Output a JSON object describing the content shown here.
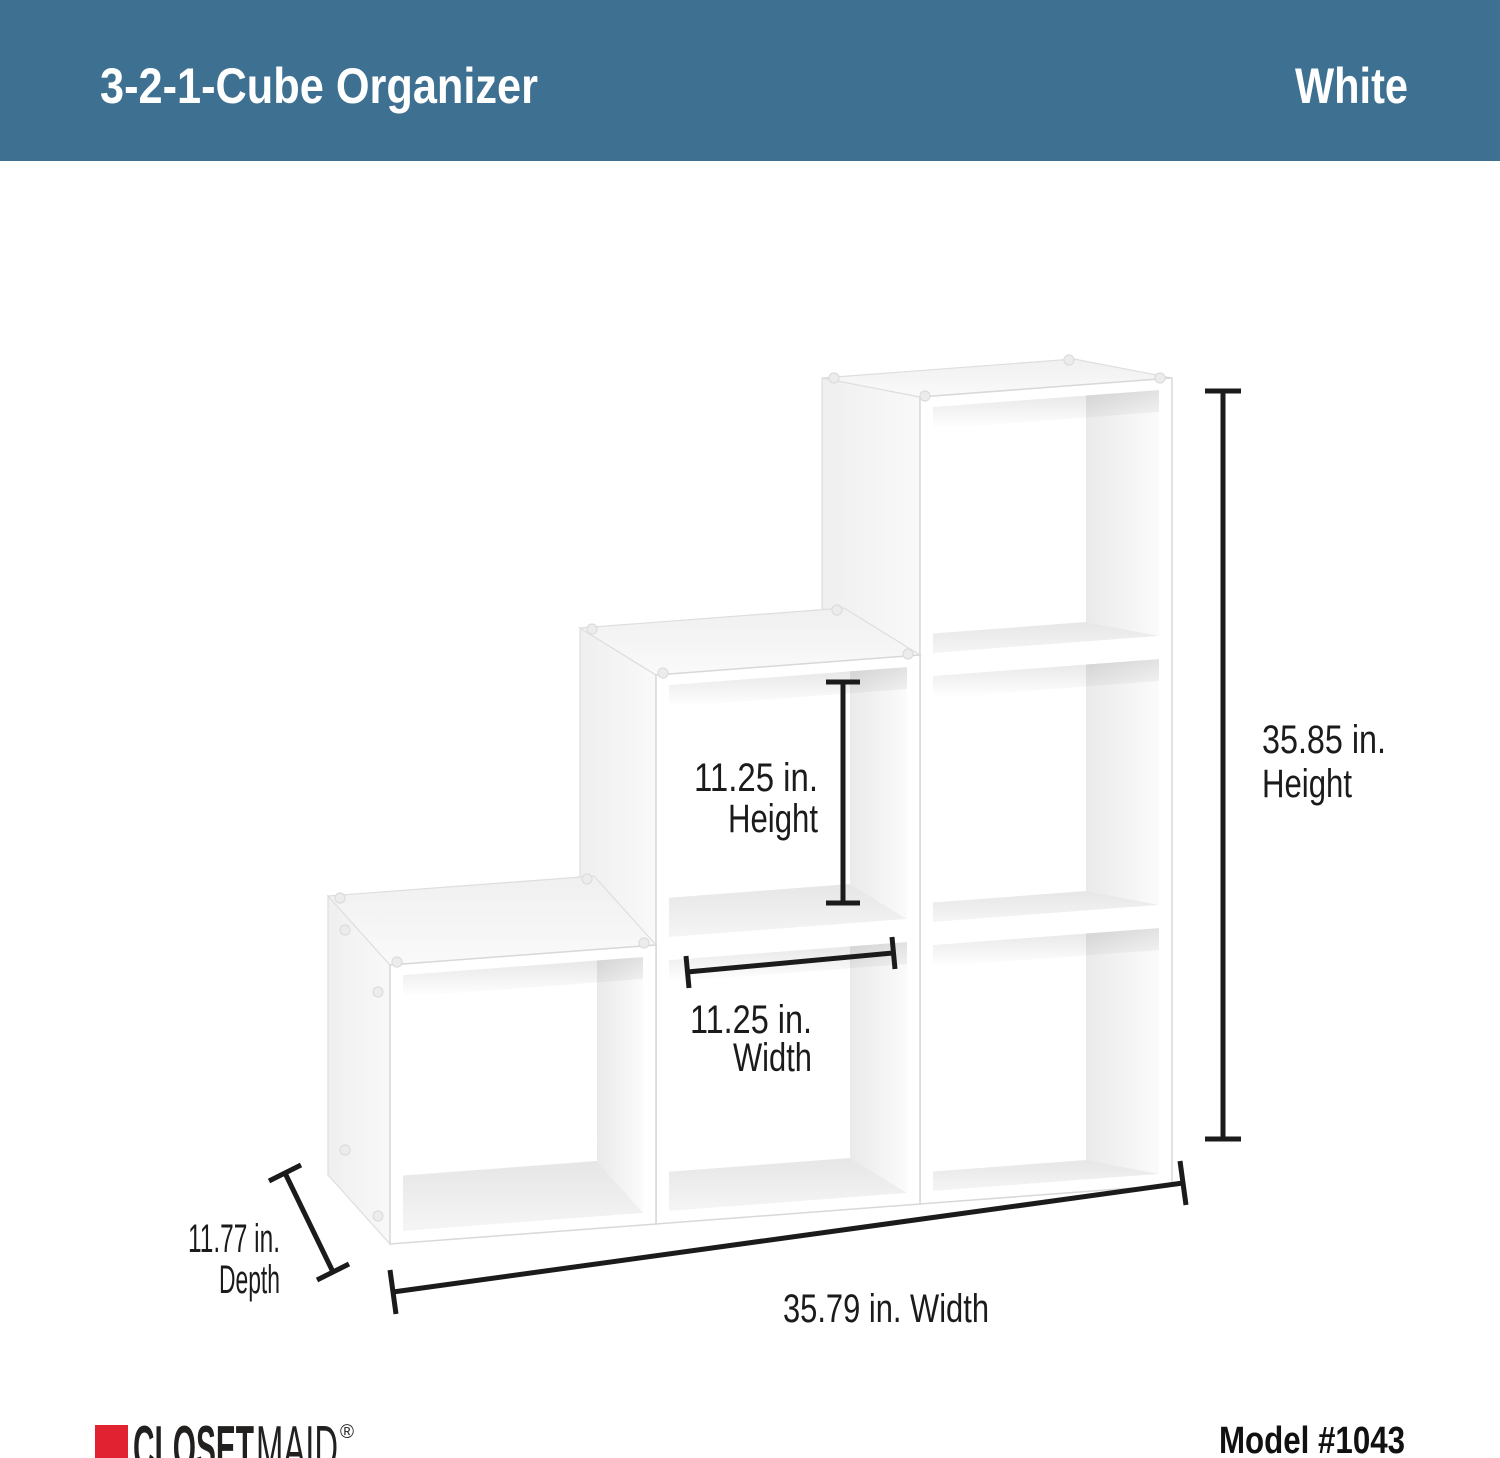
{
  "header": {
    "title": "3-2-1-Cube Organizer",
    "color_label": "White"
  },
  "dimensions": {
    "inner_height": {
      "value": "11.25 in.",
      "label": "Height"
    },
    "inner_width": {
      "value": "11.25 in.",
      "label": "Width"
    },
    "overall_height": {
      "value": "35.85 in.",
      "label": "Height"
    },
    "overall_width": {
      "value": "35.79 in. Width"
    },
    "depth": {
      "value": "11.77 in.",
      "label": "Depth"
    }
  },
  "footer": {
    "brand_primary": "CLOSET",
    "brand_secondary": "MAID",
    "registered_mark": "®",
    "model": "Model #1043"
  },
  "colors": {
    "header_bg": "#3e7191",
    "header_text": "#ffffff",
    "dimension_ink": "#1b1b1b",
    "brand_red": "#e02231",
    "brand_ink": "#221f1f"
  }
}
